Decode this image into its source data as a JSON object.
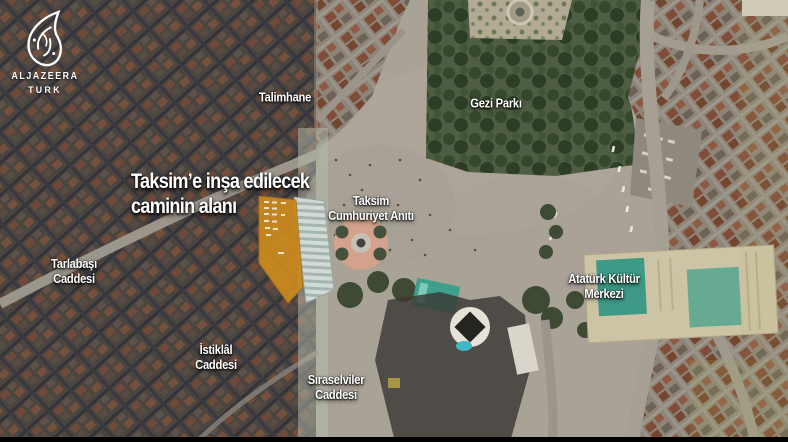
{
  "branding": {
    "network_name": "ALJAZEERA",
    "channel_name": "TURK"
  },
  "annotation": {
    "headline_line1": "Taksim’e inşa edilecek",
    "headline_line2": "caminin alanı",
    "highlight_color": "#cf8c1d"
  },
  "map_labels": {
    "talimhane": "Talimhane",
    "gezi_parki": "Gezi Parkı",
    "taksim_aniti_line1": "Taksim",
    "taksim_aniti_line2": "Cumhuriyet Anıtı",
    "ataturk_kultur_line1": "Atatürk Kültür",
    "ataturk_kultur_line2": "Merkezi",
    "tarlabasi_line1": "Tarlabaşı",
    "tarlabasi_line2": "Caddesi",
    "istiklal_line1": "İstiklâl",
    "istiklal_line2": "Caddesi",
    "siraselviler_line1": "Sıraselviler",
    "siraselviler_line2": "Caddesi"
  }
}
